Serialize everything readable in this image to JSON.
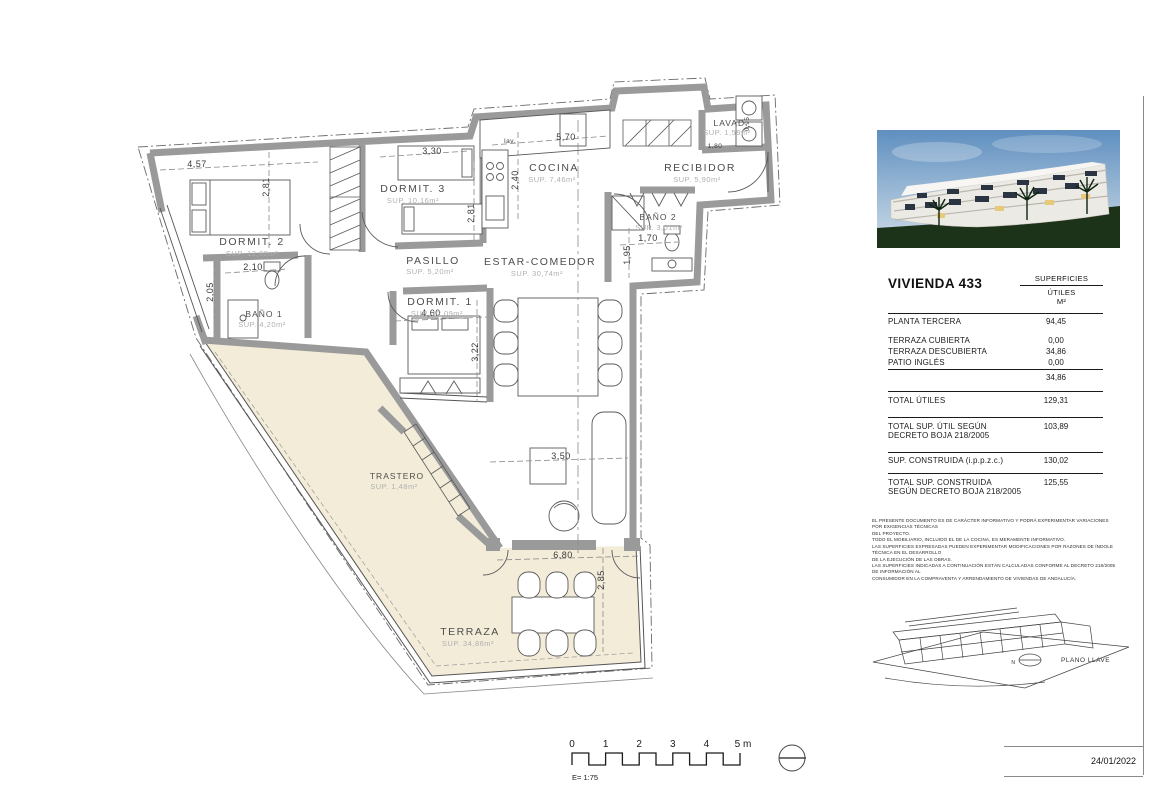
{
  "meta": {
    "date": "24/01/2022",
    "scale_label": "E= 1:75"
  },
  "scalebar": {
    "ticks": [
      "0",
      "1",
      "2",
      "3",
      "4",
      "5 m"
    ]
  },
  "plan": {
    "colors": {
      "terrace_fill": "#f3ecd9",
      "wall_gray": "#9a9a9a"
    },
    "rooms": [
      {
        "name": "DORMIT. 2",
        "sup": "SUP. 12,62m²"
      },
      {
        "name": "DORMIT. 3",
        "sup": "SUP. 10,16m²"
      },
      {
        "name": "DORMIT. 1",
        "sup": "SUP. 12,09m²"
      },
      {
        "name": "PASILLO",
        "sup": "SUP. 5,20m²"
      },
      {
        "name": "COCINA",
        "sup": "SUP. 7,46m²"
      },
      {
        "name": "RECIBIDOR",
        "sup": "SUP. 5,90m²"
      },
      {
        "name": "LAVAD.",
        "sup": "SUP. 1,59m²"
      },
      {
        "name": "BAÑO 1",
        "sup": "SUP. 4,20m²"
      },
      {
        "name": "BAÑO 2",
        "sup": "SUP. 3,01m²"
      },
      {
        "name": "ESTAR-COMEDOR",
        "sup": "SUP. 30,74m²"
      },
      {
        "name": "TRASTERO",
        "sup": "SUP. 1,48m²"
      },
      {
        "name": "TERRAZA",
        "sup": "SUP. 34,86m²"
      }
    ],
    "dims": {
      "d457": "4,57",
      "d281a": "2,81",
      "d330": "3,30",
      "d281b": "2,81",
      "d240": "2,40",
      "d570": "5,70",
      "dlav": "lav.",
      "d180": "1,80",
      "d095": "0,95",
      "d210": "2,10",
      "d205": "2,05",
      "d460": "4,60",
      "d322": "3,22",
      "d170": "1,70",
      "d195": "1,95",
      "d350": "3,50",
      "d680": "6,80",
      "d285": "2,85"
    }
  },
  "panel": {
    "title": "VIVIENDA 433",
    "header": {
      "l1": "SUPERFICIES",
      "l2": "ÚTILES",
      "l3": "M²"
    },
    "rows": [
      {
        "label": "PLANTA TERCERA",
        "value": "94,45"
      },
      {
        "label": "TERRAZA CUBIERTA",
        "value": "0,00"
      },
      {
        "label": "TERRAZA DESCUBIERTA",
        "value": "34,86"
      },
      {
        "label": "PATIO INGLÉS",
        "value": "0,00"
      }
    ],
    "subtotal": "34,86",
    "totals": [
      {
        "label": "TOTAL ÚTILES",
        "value": "129,31"
      },
      {
        "label": "TOTAL SUP. ÚTIL SEGÚN DECRETO BOJA 218/2005",
        "value": "103,89"
      },
      {
        "label": "SUP. CONSTRUIDA (i.p.p.z.c.)",
        "value": "130,02"
      },
      {
        "label": "TOTAL SUP. CONSTRUIDA SEGÚN DECRETO BOJA 218/2005",
        "value": "125,55"
      }
    ],
    "disclaimer": [
      "EL PRESENTE DOCUMENTO ES DE CARÁCTER INFORMATIVO Y PODRÁ EXPERIMENTAR VARIACIONES POR EXIGENCIAS TÉCNICAS",
      "DEL PROYECTO.",
      "TODO EL MOBILIARIO, INCLUIDO EL DE LA COCINA, ES MERAMENTE INFORMATIVO.",
      "LAS SUPERFICIES EXPRESADAS PUEDEN EXPERIMENTAR MODIFICACIONES POR RAZONES DE ÍNDOLE TÉCNICA EN EL DESARROLLO",
      "DE LA EJECUCIÓN DE LAS OBRAS.",
      "LAS SUPERFICIES INDICADAS A CONTINUACIÓN ESTÁN CALCULADAS CONFORME AL DECRETO 218/2005 DE INFORMACIÓN AL",
      "CONSUMIDOR EN LA COMPRAVENTA Y ARRENDAMIENTO DE VIVIENDAS DE ANDALUCÍA."
    ],
    "keyplan": {
      "north": "N",
      "label": "PLANO LLAVE"
    }
  }
}
